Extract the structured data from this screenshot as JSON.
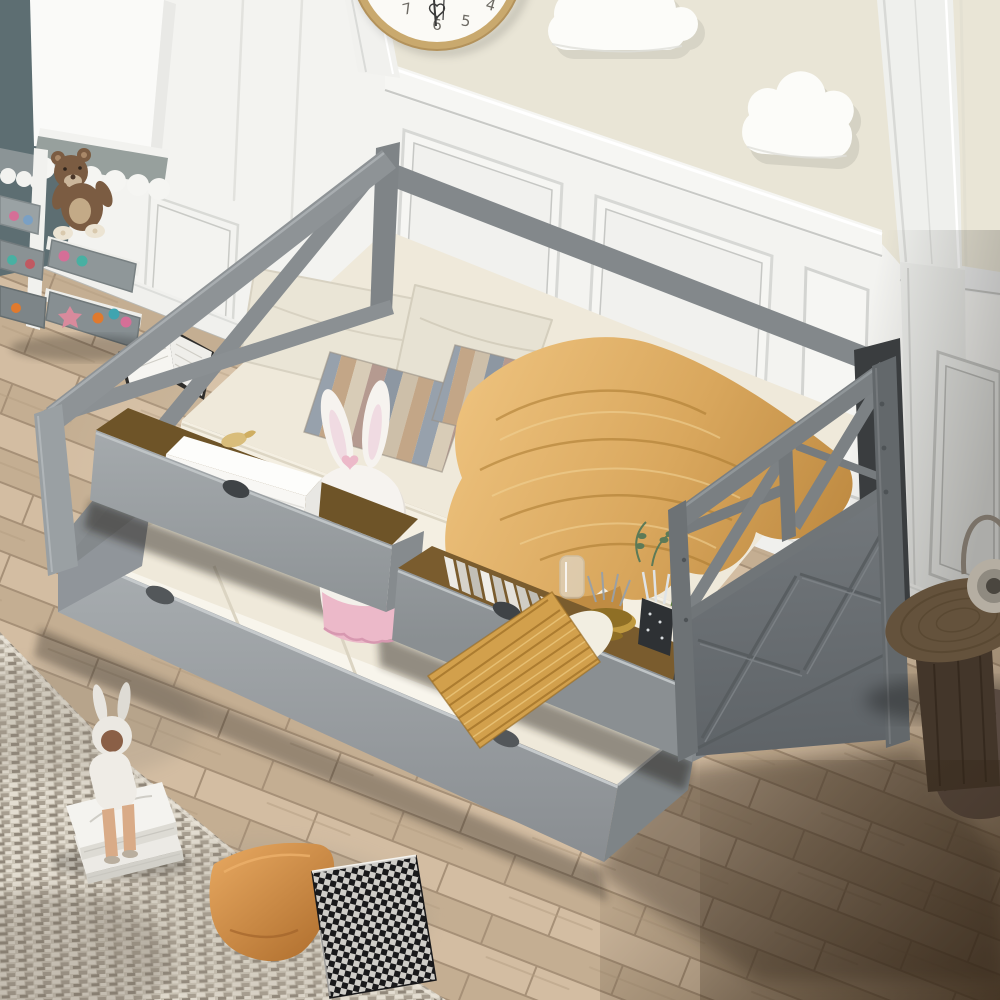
{
  "scene": {
    "description": "Photograph of a gray wood daybed with X-lattice head and foot panels, two pulled-out storage drawers and a pulled-out trundle bed, styled in a kids bedroom with paneled walls, wall clock, cloud decor, toy shelf, wood floor and rug"
  },
  "clock": {
    "numerals": [
      "7",
      "6",
      "5",
      "4"
    ]
  },
  "palette": {
    "wall_cream": "#e9e5d6",
    "wall_white": "#f3f3f0",
    "panel_shadow": "#d2d3d0",
    "rail_highlight": "#ffffff",
    "slate_teal": "#5d6e72",
    "awning_gray": "#97a09d",
    "teddy_brown": "#7b5c42",
    "frame_light": "#9ba0a3",
    "frame_mid": "#84898c",
    "frame_dark": "#6b7073",
    "frame_deep": "#5f6467",
    "mattress_cream": "#efe9da",
    "sheet_white": "#f4efe2",
    "bedding_shadow": "#d8d1be",
    "blanket_gold": "#d9a75d",
    "blanket_gold_dark": "#b3813b",
    "blanket_gold_light": "#ecc07b",
    "pillow_cream": "#eae5d6",
    "stripe_1": "#cdbfa9",
    "stripe_2": "#97a1ac",
    "stripe_3": "#c3a687",
    "stripe_4": "#b59a90",
    "stripe_5": "#8d97a2",
    "stripe_6": "#d8ccb7",
    "gold_pillow": "#d2a04c",
    "gold_pillow_dark": "#ac7c30",
    "bunny_white": "#f6f3ef",
    "bunny_pink": "#ecb9c9",
    "box_white": "#f8f7f4",
    "gold_accent": "#c9a24a",
    "floor_base": "#cab295",
    "floor_light": "#d3bda2",
    "floor_mid": "#c4ae92",
    "floor_seam": "#a69077",
    "floor_dark": "#6e5d4a",
    "rug_base": "#ccc5b7",
    "rug_light": "#e3ddd1",
    "rug_mid": "#a79e90",
    "rug_dark": "#90877a",
    "orange_pillow": "#cf8b45",
    "orange_pillow_dark": "#a96a2c",
    "check_dark": "#1e1e20",
    "check_light": "#f1efe9",
    "stool_wood": "#64523c",
    "stool_wood_dark": "#43362a",
    "curtain_dark": "#3a3d3f",
    "clock_rim": "#c9a96e",
    "clock_face": "#fbfaf6",
    "clock_hand": "#3a3a3a",
    "book_page": "#f6f5f1",
    "plant_green": "#5d7a57",
    "drawer_interior": "#6e5428"
  }
}
